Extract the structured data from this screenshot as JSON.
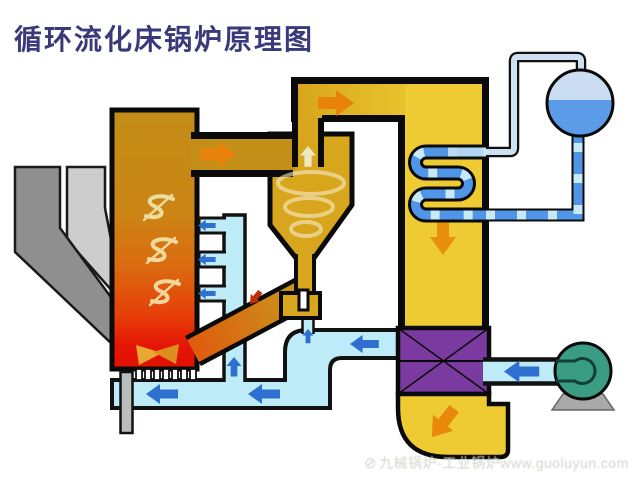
{
  "title": "循环流化床锅炉原理图",
  "watermark": {
    "logo": "⊘",
    "text": "九械锅炉-工业锅炉www.guoluyun.com"
  },
  "diagram": {
    "type": "schematic",
    "subject": "circulating fluidized bed boiler flow diagram",
    "components": [
      {
        "name": "coal-chute-dark",
        "color": "#8F8F8F"
      },
      {
        "name": "coal-chute-light",
        "color": "#CDCDCD"
      },
      {
        "name": "furnace",
        "color_top": "#C28E16",
        "color_middle": "#DB6A10",
        "color_bottom": "#E61505"
      },
      {
        "name": "cyclone-separator",
        "color": "#D8A61C"
      },
      {
        "name": "loopseal-return-leg",
        "color": "#D08018"
      },
      {
        "name": "backpass-duct",
        "color": "#EFCB33"
      },
      {
        "name": "superheater-coil",
        "color": "#4F96E8",
        "dash_color": "#C7E9F8"
      },
      {
        "name": "steam-drum",
        "steam_color": "#CBDDF2",
        "water_color": "#5B9BE8"
      },
      {
        "name": "air-preheater",
        "color": "#7B3AA0"
      },
      {
        "name": "flue-gas-elbow",
        "color": "#EFCB33"
      },
      {
        "name": "fan",
        "color": "#3A9C82"
      },
      {
        "name": "air-duct",
        "color": "#BEEBF8"
      },
      {
        "name": "air-nozzles",
        "color": "#FFFFFF"
      },
      {
        "name": "ash-drain-pipe",
        "color": "#B9BDBD"
      }
    ],
    "flow_arrow_colors": {
      "hot_gas": "#E8820A",
      "air": "#2E6FD0",
      "solids_return": "#C03008"
    },
    "outline_color": "#0A0A0A",
    "title_color": "#3A3A7A",
    "background": "#FFFFFF"
  }
}
